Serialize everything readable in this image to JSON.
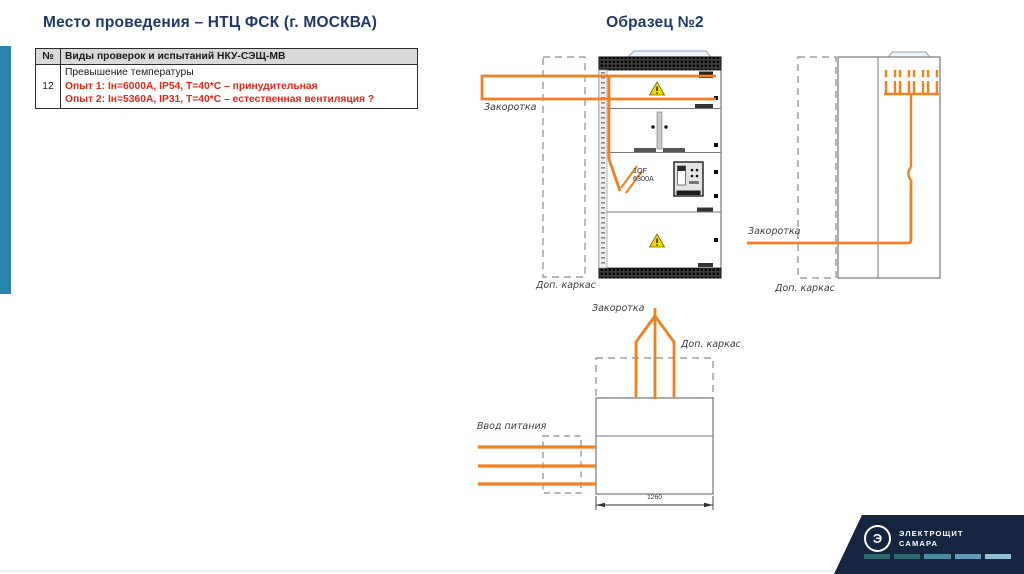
{
  "slide": {
    "title_left": "Место проведения – НТЦ ФСК (г. МОСКВА)",
    "title_right": "Образец №2"
  },
  "table": {
    "header": {
      "num": "№",
      "desc": "Виды проверок и испытаний НКУ-СЭЩ-МВ"
    },
    "row": {
      "num": "12",
      "line1": "Превышение температуры",
      "line2": "Опыт 1: Iн=6000А, IP54, Т=40*С – принудительная",
      "line3": "Опыт 2: Iн=5360А, IP31, Т=40*С – естественная вентиляция ?"
    }
  },
  "diagram_front": {
    "label_shunt": "Закоротка",
    "label_frame": "Доп. каркас",
    "breaker_label_line1": "1QF",
    "breaker_label_line2": "6300А"
  },
  "diagram_side": {
    "label_shunt": "Закоротка",
    "label_frame": "Доп. каркас"
  },
  "diagram_plan": {
    "label_shunt": "Закоротка",
    "label_frame": "Доп. каркас",
    "label_input": "Ввод питания",
    "dimension": "1260"
  },
  "logo": {
    "glyph": "Э",
    "line1": "ЭЛЕКТРОЩИТ",
    "line2": "САМАРА",
    "dash_colors": [
      "#2b666d",
      "#2b666d",
      "#4e8aa3",
      "#649cb8",
      "#8fc0d6"
    ]
  },
  "colors": {
    "accent_orange": "#F08020",
    "title_navy": "#1F3864",
    "red_text": "#E2261C",
    "sidebar_teal": "#2A85AD",
    "logo_navy": "#15253F",
    "table_header_bg": "#D9D9D9"
  }
}
